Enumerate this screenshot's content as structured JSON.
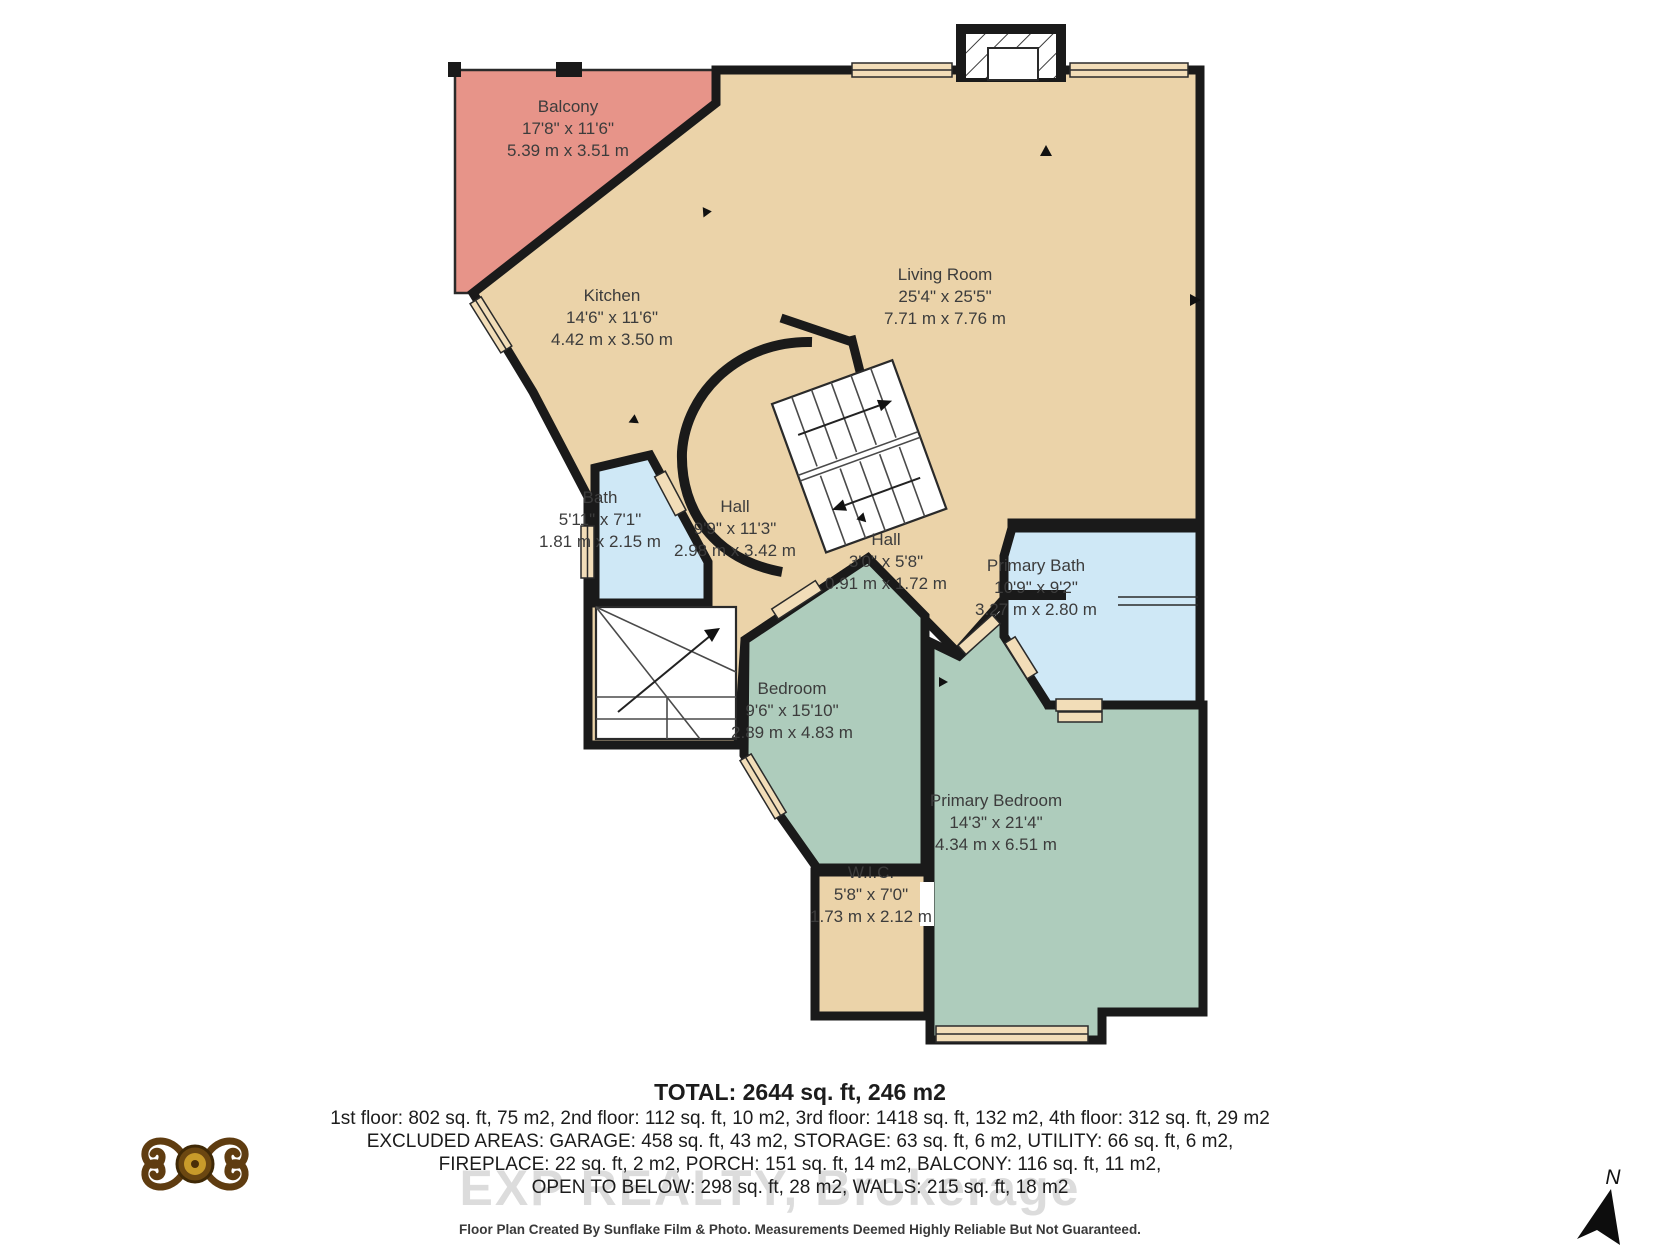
{
  "floor_plan": {
    "rooms": [
      {
        "name": "Balcony",
        "imperial": "17'8\" x 11'6\"",
        "metric": "5.39 m x 3.51 m"
      },
      {
        "name": "Kitchen",
        "imperial": "14'6\" x 11'6\"",
        "metric": "4.42 m x 3.50 m"
      },
      {
        "name": "Living Room",
        "imperial": "25'4\" x 25'5\"",
        "metric": "7.71 m x 7.76 m"
      },
      {
        "name": "Bath",
        "imperial": "5'11\" x 7'1\"",
        "metric": "1.81 m x 2.15 m"
      },
      {
        "name": "Hall",
        "imperial": "9'9\" x 11'3\"",
        "metric": "2.98 m x 3.42 m"
      },
      {
        "name": "Hall",
        "imperial": "3'0\" x 5'8\"",
        "metric": "0.91 m x 1.72 m"
      },
      {
        "name": "Primary Bath",
        "imperial": "10'9\" x 9'2\"",
        "metric": "3.27 m x 2.80 m"
      },
      {
        "name": "Bedroom",
        "imperial": "9'6\" x 15'10\"",
        "metric": "2.89 m x 4.83 m"
      },
      {
        "name": "Primary Bedroom",
        "imperial": "14'3\" x 21'4\"",
        "metric": "4.34 m x 6.51 m"
      },
      {
        "name": "W.I.C.",
        "imperial": "5'8\" x 7'0\"",
        "metric": "1.73 m x 2.12 m"
      }
    ],
    "north_label": "N"
  },
  "summary": {
    "total": "TOTAL: 2644 sq. ft, 246 m2",
    "floors": "1st floor: 802 sq. ft, 75 m2, 2nd floor: 112 sq. ft, 10 m2, 3rd floor: 1418 sq. ft, 132 m2, 4th floor: 312 sq. ft, 29 m2",
    "excluded_1": "EXCLUDED AREAS: GARAGE: 458 sq. ft, 43 m2, STORAGE: 63 sq. ft, 6 m2, UTILITY: 66 sq. ft, 6 m2,",
    "excluded_2": "FIREPLACE: 22 sq. ft, 2 m2, PORCH: 151 sq. ft, 14 m2, BALCONY: 116 sq. ft, 11 m2,",
    "excluded_3": "OPEN TO BELOW: 298 sq. ft, 28 m2, WALLS: 215 sq. ft, 18 m2",
    "watermark": "EXP REALTY, Brokerage",
    "disclaimer": "Floor Plan Created By Sunflake Film & Photo. Measurements Deemed Highly Reliable But Not Guaranteed."
  },
  "colors": {
    "balcony_pink": "#e79489",
    "floor_tan": "#ebd3a9",
    "bath_blue": "#cfe8f6",
    "bedroom_green": "#aeccbc",
    "window_tan": "#f2ddb8",
    "wall_black": "#1a1a1a",
    "watermark_gray": "#dcdcdc",
    "logo_gold": "#c89b2a",
    "logo_brown": "#6b4711"
  }
}
